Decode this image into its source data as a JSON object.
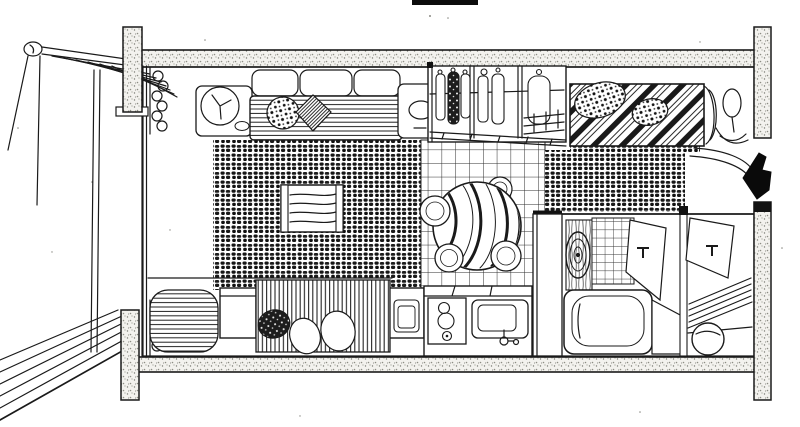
{
  "page": {
    "width": 800,
    "height": 427,
    "background": "#ffffff"
  },
  "drawing": {
    "title": "Hand-drawn axonometric cutaway floor plan of a studio apartment",
    "medium": "pen-and-ink sketch, scanned",
    "ink_color": "#1a1a1a",
    "paper_color": "#ffffff",
    "wall_fill": "concrete stipple",
    "entry_arrow": {
      "shape": "solid arrow",
      "direction": "left",
      "color": "#0a0a0a"
    },
    "rooms": [
      {
        "name": "balcony",
        "features": [
          "railing with round cap",
          "diagonal deck planks",
          "support posts"
        ]
      },
      {
        "name": "window-wall",
        "features": [
          "floor-to-ceiling glass",
          "scalloped curtains top",
          "scalloped curtains bottom"
        ]
      },
      {
        "name": "living-area",
        "features": [
          "sofa with back cushions",
          "round side table with fan tray",
          "dotted throw pillow",
          "hatched diamond pillow",
          "end table with bowl",
          "dark cobble area rug",
          "tv-console with wood grain"
        ]
      },
      {
        "name": "dining-area",
        "features": [
          "checkered tile floor",
          "round table with striped cloth",
          "four round stools"
        ]
      },
      {
        "name": "kitchen",
        "features": [
          "appliance cabinet",
          "two-burner stove",
          "sink with faucet",
          "counter divider"
        ]
      },
      {
        "name": "wardrobe",
        "features": [
          "three closet sections",
          "hanging garments",
          "dark patterned garment",
          "hanger rail",
          "base drawers",
          "shelf grid"
        ]
      },
      {
        "name": "sleeping-area",
        "features": [
          "bed with diagonal striped duvet",
          "two polka-dot pillows",
          "rolled duvet end",
          "bedside lamp",
          "dark cobble bedside rug"
        ]
      },
      {
        "name": "second-bed",
        "features": [
          "rolled blanket with stripes",
          "cube side table",
          "fringed mattress cover",
          "dark speckled pillow",
          "two white pillows"
        ]
      },
      {
        "name": "bathroom",
        "features": [
          "partition slab",
          "wood-grain vanity panel",
          "concentric oval basin",
          "tiled wall",
          "bathtub with ledge",
          "open door with t-handle"
        ]
      },
      {
        "name": "utility-room",
        "features": [
          "open door with t-handle",
          "slatted mat",
          "round laundry basket"
        ]
      },
      {
        "name": "entry",
        "features": [
          "genkan step curves",
          "black entrance arrow pointing left"
        ]
      }
    ],
    "structure": [
      "top wall band",
      "bottom wall band",
      "four stippled column stubs",
      "right wall entry gap",
      "scan artifact bar at top"
    ]
  }
}
